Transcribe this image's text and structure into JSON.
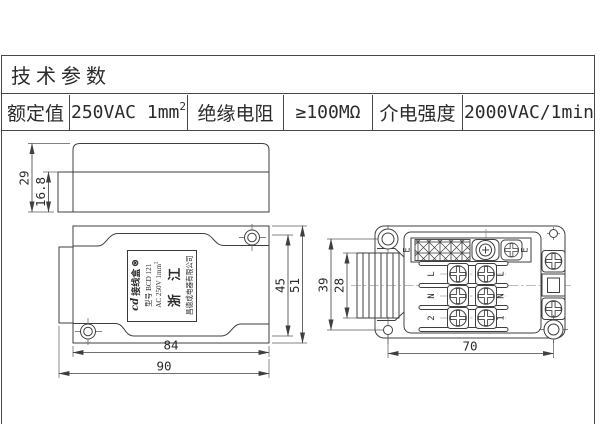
{
  "spec_table": {
    "title": "技术参数",
    "rated_label": "额定值",
    "rated_value": "250VAC 1mm",
    "rated_value_sup": "2",
    "insulation_label": "绝缘电阻",
    "insulation_value": "≥100MΩ",
    "dielectric_label": "介电强度",
    "dielectric_value": "2000VAC/1min"
  },
  "side_view": {
    "total_height": "29",
    "base_height": "16.8"
  },
  "top_view": {
    "body_height": "45",
    "overall_height": "51",
    "body_width": "84",
    "overall_width": "90",
    "plate": {
      "logo": "cd",
      "product": "接线盒",
      "cert_mark": "⊛",
      "model": "型号 BCD 121",
      "rating": "AC 250V 1mm",
      "rating_sup": "2",
      "region": "浙  江",
      "company": "昌德成电器有限公司"
    }
  },
  "terminal_view": {
    "screw_span_height": "39",
    "gland_height": "28",
    "screw_span_width": "70",
    "earth_left": "E",
    "earth_right": "E",
    "rows_left": [
      "L",
      "N",
      "2"
    ],
    "rows_right": [
      "L",
      "N",
      "1"
    ]
  }
}
